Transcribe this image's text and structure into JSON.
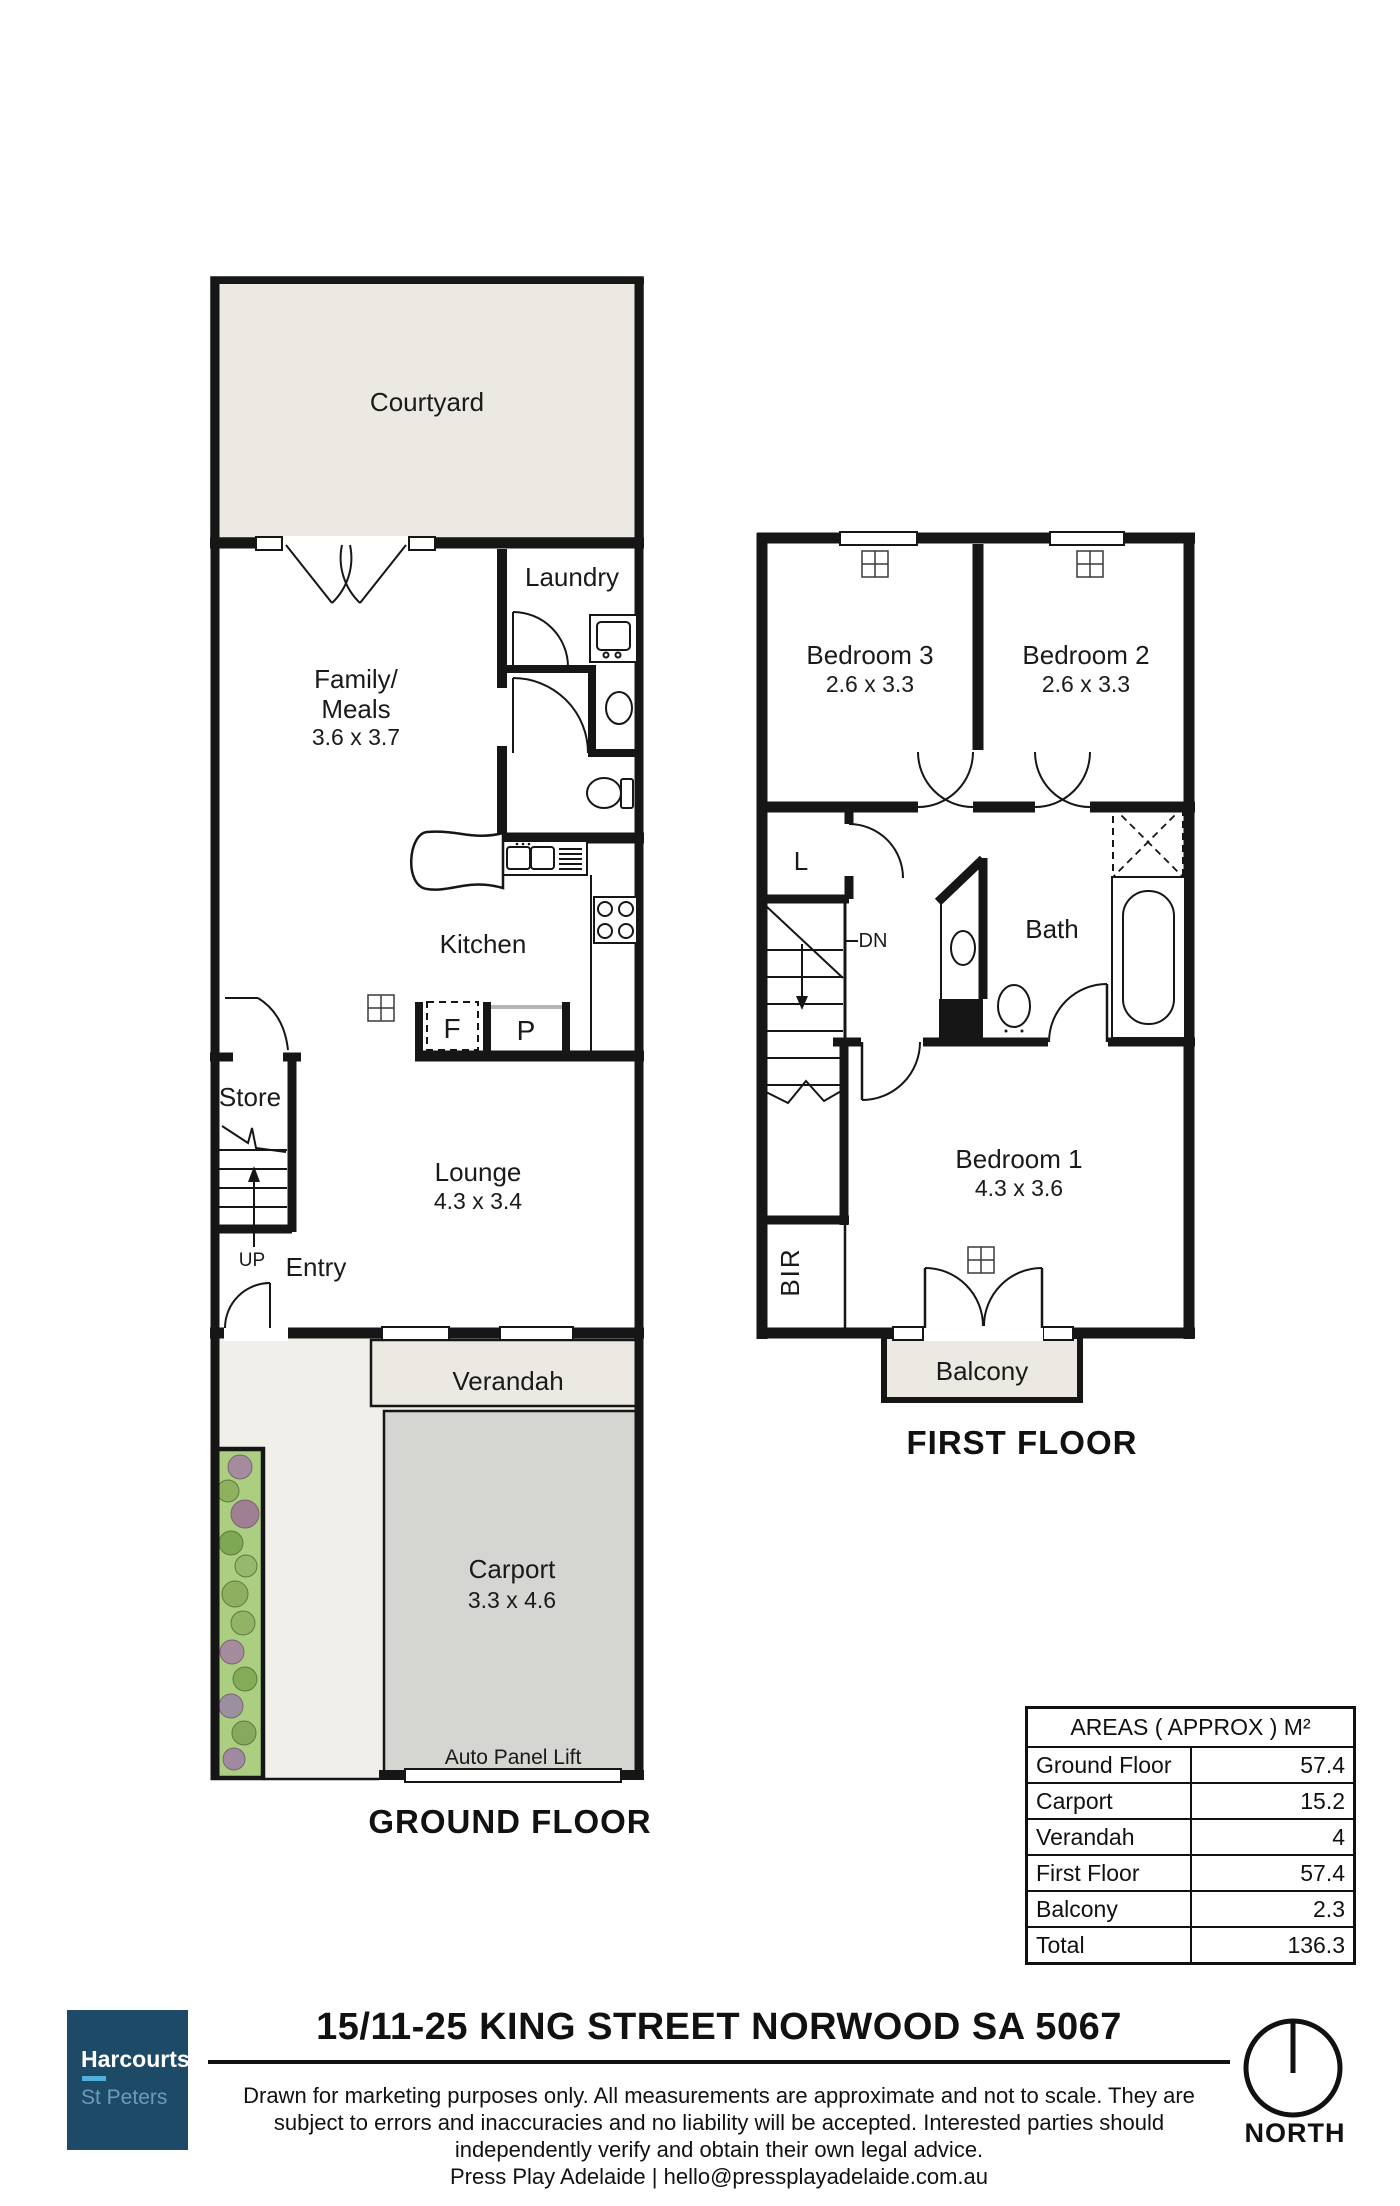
{
  "colors": {
    "wall": "#161616",
    "courtyard_fill": "#ebe9e2",
    "carport_fill": "#d5d5d2",
    "path_fill": "#f0efe9",
    "garden_fill": "#abce81",
    "logo_bg": "#1d4a66",
    "logo_accent": "#4fb0d8",
    "logo_sub": "#6d9cb8",
    "text": "#1a1a1a"
  },
  "ground_floor": {
    "caption": "GROUND FLOOR",
    "courtyard": "Courtyard",
    "family_line1": "Family/",
    "family_line2": "Meals",
    "family_dims": "3.6 x 3.7",
    "laundry": "Laundry",
    "kitchen": "Kitchen",
    "fridge": "F",
    "pantry": "P",
    "store": "Store",
    "up": "UP",
    "entry": "Entry",
    "lounge": "Lounge",
    "lounge_dims": "4.3 x 3.4",
    "verandah": "Verandah",
    "carport": "Carport",
    "carport_dims": "3.3 x 4.6",
    "auto_panel_lift": "Auto Panel Lift"
  },
  "first_floor": {
    "caption": "FIRST FLOOR",
    "bedroom3": "Bedroom 3",
    "bedroom3_dims": "2.6 x 3.3",
    "bedroom2": "Bedroom 2",
    "bedroom2_dims": "2.6 x 3.3",
    "linen": "L",
    "dn": "DN",
    "bath": "Bath",
    "bedroom1": "Bedroom 1",
    "bedroom1_dims": "4.3 x 3.6",
    "bir": "BIR",
    "balcony": "Balcony"
  },
  "areas_table": {
    "header": "AREAS ( APPROX ) M²",
    "rows": [
      {
        "label": "Ground Floor",
        "value": "57.4"
      },
      {
        "label": "Carport",
        "value": "15.2"
      },
      {
        "label": "Verandah",
        "value": "4"
      },
      {
        "label": "First Floor",
        "value": "57.4"
      },
      {
        "label": "Balcony",
        "value": "2.3"
      },
      {
        "label": "Total",
        "value": "136.3"
      }
    ]
  },
  "footer": {
    "agency_name": "Harcourts",
    "agency_branch": "St Peters",
    "address_title": "15/11-25 KING STREET NORWOOD SA 5067",
    "disclaimer_lines": [
      "Drawn for marketing purposes only. All measurements are approximate and not to scale. They are",
      "subject to errors and inaccuracies and no liability will be accepted. Interested parties should",
      "independently verify and obtain their own legal advice."
    ],
    "contact_line": "Press Play Adelaide | hello@pressplayadelaide.com.au",
    "north_label": "NORTH"
  }
}
